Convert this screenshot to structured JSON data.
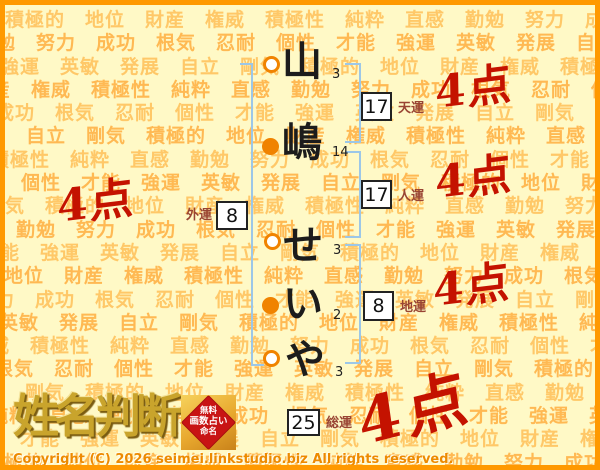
{
  "page": {
    "title": "姓名判断 結果",
    "background_color": "#FFF9C6",
    "border_color": "#FF9900"
  },
  "background": {
    "words": [
      "積極的",
      "地位",
      "財産",
      "権威",
      "積極性",
      "純粋",
      "直感",
      "勤勉",
      "努力",
      "成功",
      "根気",
      "忍耐",
      "個性",
      "才能",
      "強運",
      "英敏",
      "発展",
      "自立",
      "剛気"
    ],
    "color_light": "#FFC868",
    "color_dark": "#FFB953"
  },
  "name": {
    "full": "山嶋せいや",
    "characters": [
      {
        "char": "山",
        "strokes": "3",
        "circle": "hollow"
      },
      {
        "char": "嶋",
        "strokes": "14",
        "circle": "filled"
      },
      {
        "char": "せ",
        "strokes": "3",
        "circle": "hollow"
      },
      {
        "char": "い",
        "strokes": "2",
        "circle": "filled"
      },
      {
        "char": "や",
        "strokes": "3",
        "circle": "hollow"
      }
    ]
  },
  "fortunes": {
    "tenun": {
      "label": "天運",
      "value": "17",
      "score": "4点"
    },
    "jinun": {
      "label": "人運",
      "value": "17",
      "score": "4点"
    },
    "chiun": {
      "label": "地運",
      "value": "8",
      "score": "4点"
    },
    "gaiun": {
      "label": "外運",
      "value": "8",
      "score": "4点"
    },
    "souun": {
      "label": "総運",
      "value": "25",
      "score": "4点"
    }
  },
  "footer": {
    "logo_text": "姓名判断",
    "stamp_lines": [
      "無料",
      "画数占い",
      "命名"
    ],
    "copyright": "Copyright (C) 2026 seimei.linkstudio.biz All rights reserved."
  },
  "colors": {
    "page-bg": "#FFF9C6",
    "border-orange": "#FF9900",
    "word-light": "#FFC868",
    "word-dark": "#FFB953",
    "bracket-blue": "#9CC7E8",
    "circle-orange": "#F08300",
    "score-red": "#C41200",
    "label-brown": "#994433",
    "gold": "#C9A42C",
    "stamp-red": "#C81414",
    "copyright-orange": "#ED8A00"
  }
}
